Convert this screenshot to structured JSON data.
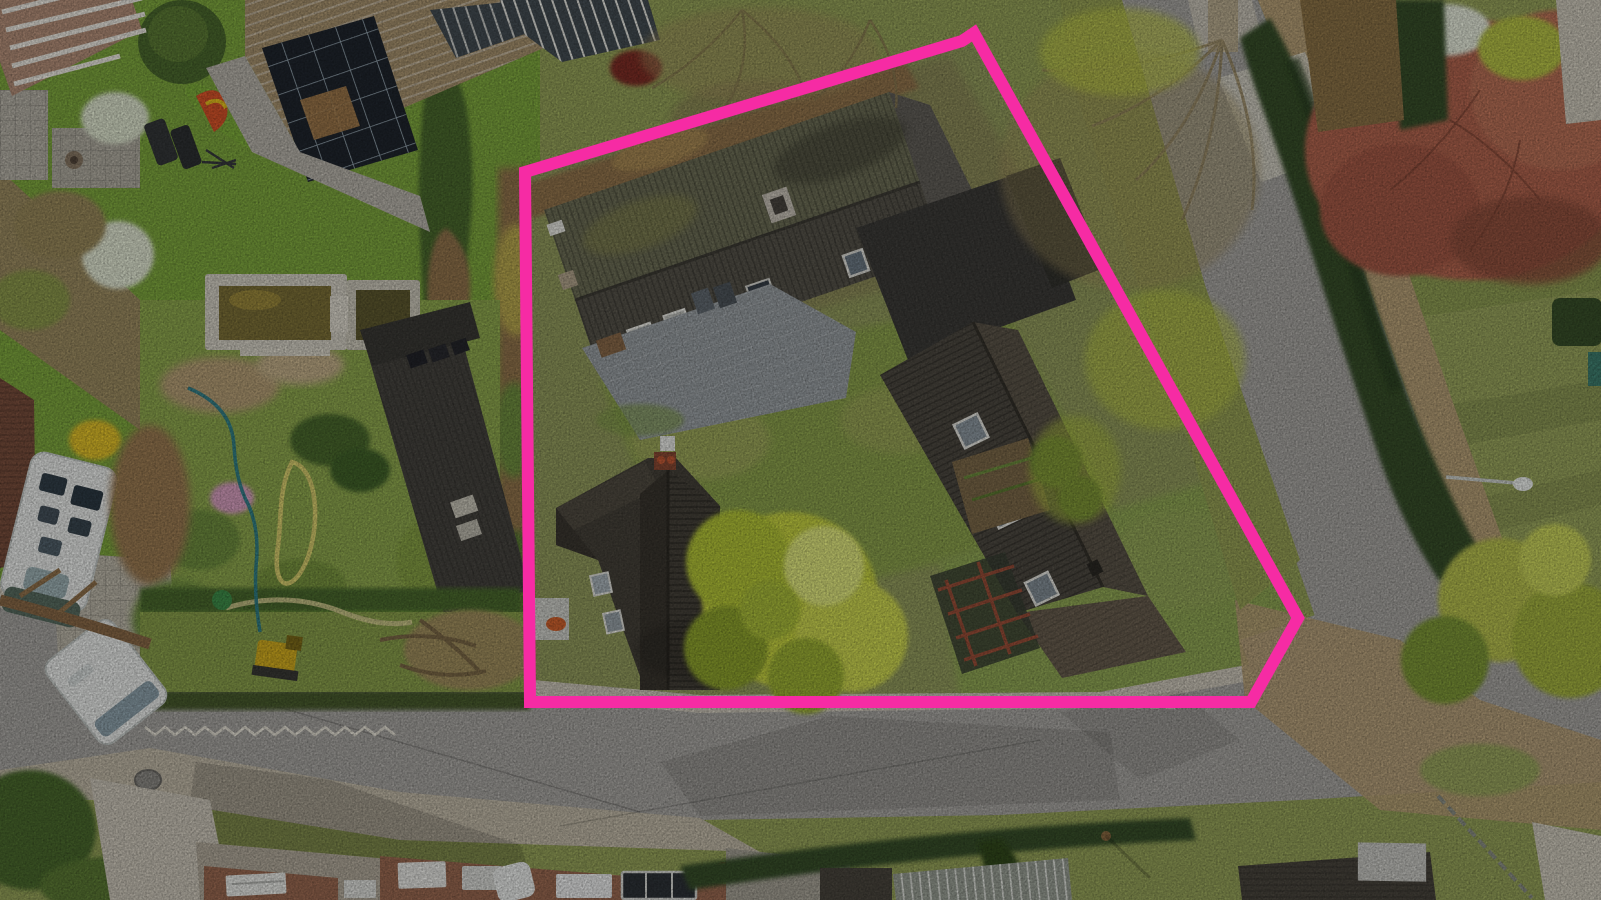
{
  "image": {
    "kind": "aerial-drone-photo",
    "description": "Top-down aerial photograph of a residential plot outlined with a pink property boundary, surrounded by neighbouring gardens, an empty swimming pool, parked camper and van, and two intersecting streets",
    "width": 1601,
    "height": 900
  },
  "boundary": {
    "label": "property-boundary",
    "color": "#f62ba4",
    "stroke_width": "12",
    "points": "525,172 962,41 974,33 1298,618 1251,702 530,702"
  },
  "palette": {
    "grass_bright": "#7fa83f",
    "grass_olive": "#96a35a",
    "grass_pale": "#a9b168",
    "grass_dark": "#5f7c33",
    "meadow_rough": "#939c5e",
    "road": "#a9a7a3",
    "road_dark": "#9a9894",
    "sidewalk": "#cdc7ba",
    "dirt": "#b7a077",
    "concrete": "#d6d2c6",
    "hedge_dark": "#39502a",
    "hedge_green": "#4c6a2f",
    "hedge_brown": "#93744e",
    "tree_chartreuse": "#c6d243",
    "tree_chartreuse_dark": "#8ea32f",
    "tree_copper": "#b2654f",
    "tree_bare": "#a2905f",
    "roof_moss": "#6e6f57",
    "roof_gray": "#57544b",
    "roof_darkhouse": "#46423a",
    "roof_right": "#4e4a42",
    "roof_flat": "#3e3d3a",
    "roof_tan": "#a8936f",
    "solar_panel": "#20262e",
    "glass_roof": "#454e54",
    "water_murky": "#7d7138",
    "brick": "#9b6a52",
    "vehicle_white": "#eceeec",
    "digger_yellow": "#d2ad20",
    "hose_blue": "#2f7f8a",
    "hose_yellow": "#d9cf6f",
    "cobble": "#9aa0a4",
    "shadow": "#000000"
  },
  "scene": {
    "outlined_plot": "plot outlined in pink containing three dark-roofed houses, a cobbled courtyard, lawns and a large chartreuse tree",
    "objects": [
      "main-house-roof",
      "second-house-roof",
      "right-house-roof",
      "flat-roof-extension",
      "courtyard-cobbles",
      "big-chartreuse-tree",
      "vegetable-patch",
      "pergola-terrace",
      "neighbor-solar-house",
      "conservatory-glass-roof",
      "pergola-corner-roof",
      "empty-swimming-pool",
      "neighbor-barn-roof",
      "white-camper-van",
      "white-van",
      "mini-digger",
      "fallen-tree",
      "garden-hoses",
      "bottom-road",
      "right-road",
      "road-junction",
      "street-lamp",
      "copper-beech-tree",
      "east-lawn",
      "brick-houses-row",
      "greenhouse",
      "hedges",
      "manhole-cover"
    ]
  }
}
